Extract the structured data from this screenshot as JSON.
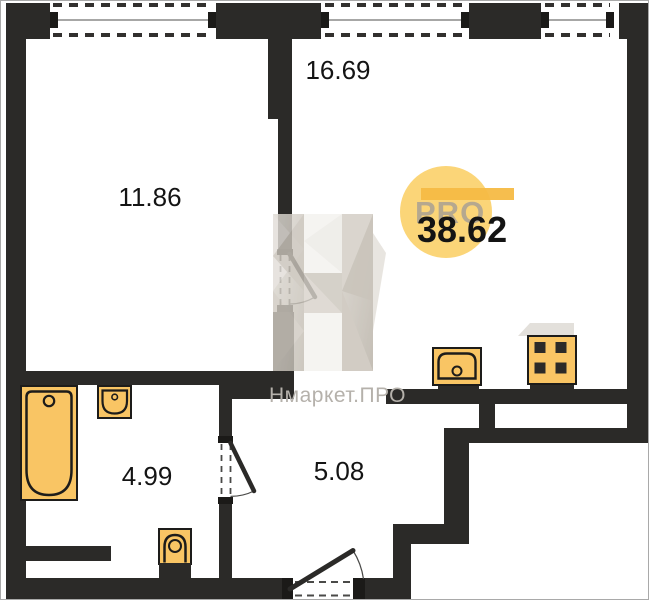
{
  "plan": {
    "title": "apartment-floor-plan",
    "total_area_label": "38.62",
    "rooms": [
      {
        "id": "living-kitchen",
        "area_label": "16.69"
      },
      {
        "id": "bedroom",
        "area_label": "11.86"
      },
      {
        "id": "bathroom",
        "area_label": "4.99"
      },
      {
        "id": "hallway",
        "area_label": "5.08"
      }
    ],
    "fixtures": [
      "bathtub",
      "bath-sink",
      "toilet",
      "kitchen-sink",
      "stove"
    ],
    "windows_count": 3,
    "doors_count": 3
  },
  "watermark": {
    "brand_text": "Нмаркет.ПРО",
    "pro_text": "PRO"
  },
  "colors": {
    "wall": "#2b2a28",
    "fixture_fill": "#f9c564",
    "fixture_stroke": "#1d1c1a",
    "badge_circle": "#fbd26e",
    "badge_bar": "#f6ba45",
    "watermark_text": "#b5b1ab",
    "label_text": "#141414"
  }
}
